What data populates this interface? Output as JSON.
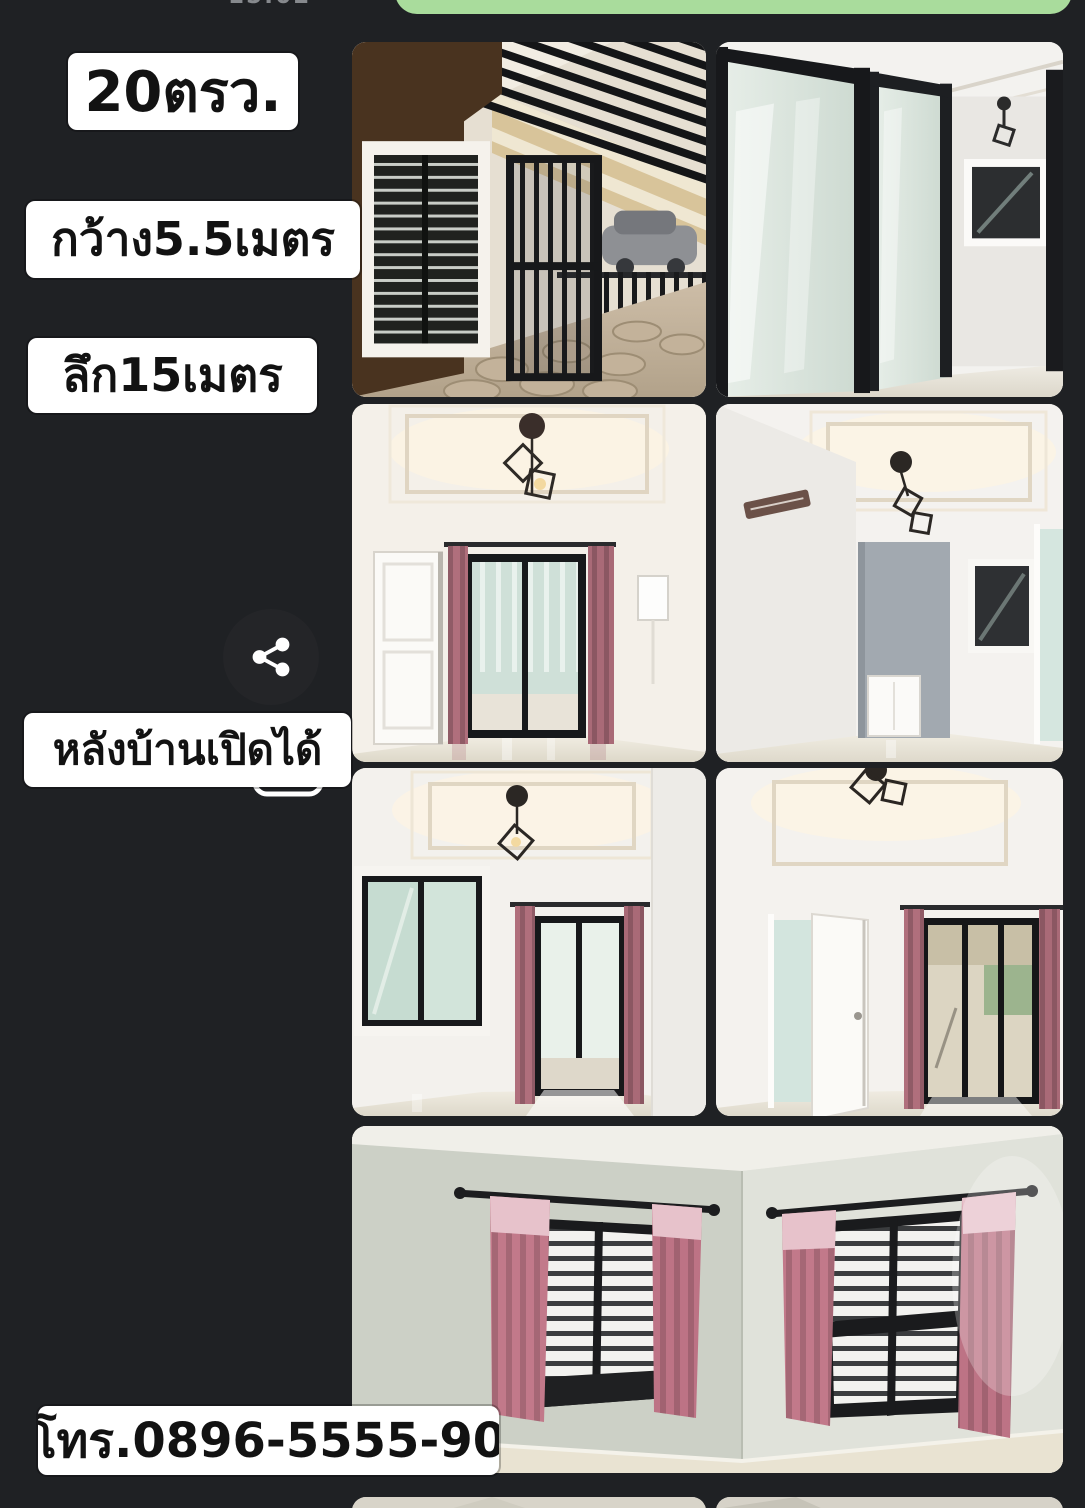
{
  "screen": {
    "background_color": "#1f2124",
    "status_timestamp_partial": "15:02"
  },
  "chat_bubble": {
    "color": "#a9dc9c"
  },
  "labels": {
    "area": "20ตรว.",
    "width": "กว้าง5.5เมตร",
    "depth": "ลึก15เมตร",
    "back_open": "หลังบ้านเปิดได้",
    "phone": "โทร.0896-5555-90"
  },
  "share_button": {
    "icon": "share-icon"
  },
  "collage": {
    "photos": [
      {
        "id": "front-porch",
        "desc": "Front porch: brown walls, barred window, black slat pergola, black gate, stone tile floor, street with car"
      },
      {
        "id": "sliding-glass-doors",
        "desc": "Black aluminium sliding glass doors into a white room with window and pendant lamp"
      },
      {
        "id": "hallway-curtains",
        "desc": "Hallway with coffered ceiling, pendant lantern lamp, white door, mauve curtains at glass door"
      },
      {
        "id": "hallway-gray-wall",
        "desc": "Hallway with ceiling lamp, gray accent wall, black framed window and doorway"
      },
      {
        "id": "room-window-sliding-door",
        "desc": "Room with black framed window, pendant lamp and curtained sliding glass door"
      },
      {
        "id": "room-open-door",
        "desc": "Room with open white door and curtained sliding doors to patio"
      },
      {
        "id": "bedroom-two-windows",
        "desc": "Bedroom corner with two black framed windows, white blinds and pink curtains"
      },
      {
        "id": "partial-left",
        "desc": "Partially visible photo at bottom edge"
      },
      {
        "id": "partial-right",
        "desc": "Partially visible photo at bottom edge"
      }
    ]
  }
}
